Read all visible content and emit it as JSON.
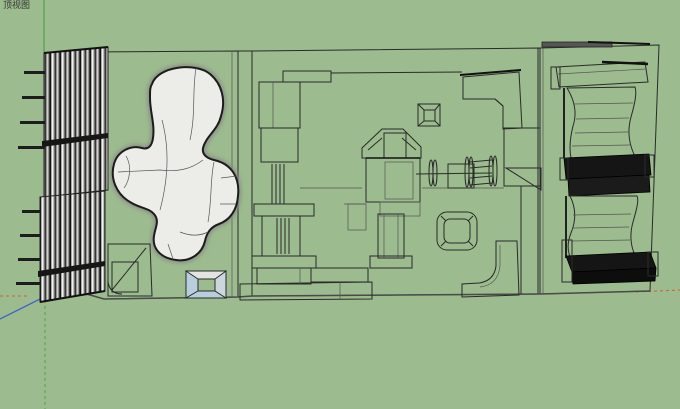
{
  "viewport": {
    "view_label": "顶视图",
    "label_color": "#333333",
    "colors": {
      "background": "#9cbb8e",
      "floor": "#cacac9",
      "wall": "#bfbfbe",
      "line": "#2a2a2a",
      "blob_fill": "#ecece8",
      "skylight_glass": "#b8cedd",
      "shelf_dark": "#151515",
      "axis_red": "#d25b3c",
      "axis_green": "#59a14e",
      "axis_blue": "#4566c8"
    },
    "model_parts": [
      "north-louver-screen",
      "south-louver-screen",
      "freeform-blob-sculpture",
      "corner-bench",
      "skylight-pit",
      "partition-wall",
      "west-storage-stack",
      "north-roof-bar",
      "south-platform-steps",
      "hip-roof-pavilion",
      "column-with-flange",
      "small-skylight-frame",
      "spool-axle-assembly",
      "corner-wedge",
      "rounded-spa-tub",
      "north-elbow-duct",
      "east-frame-wall",
      "south-elbow-duct",
      "upper-curved-shelf-unit",
      "lower-curved-shelf-unit"
    ]
  }
}
